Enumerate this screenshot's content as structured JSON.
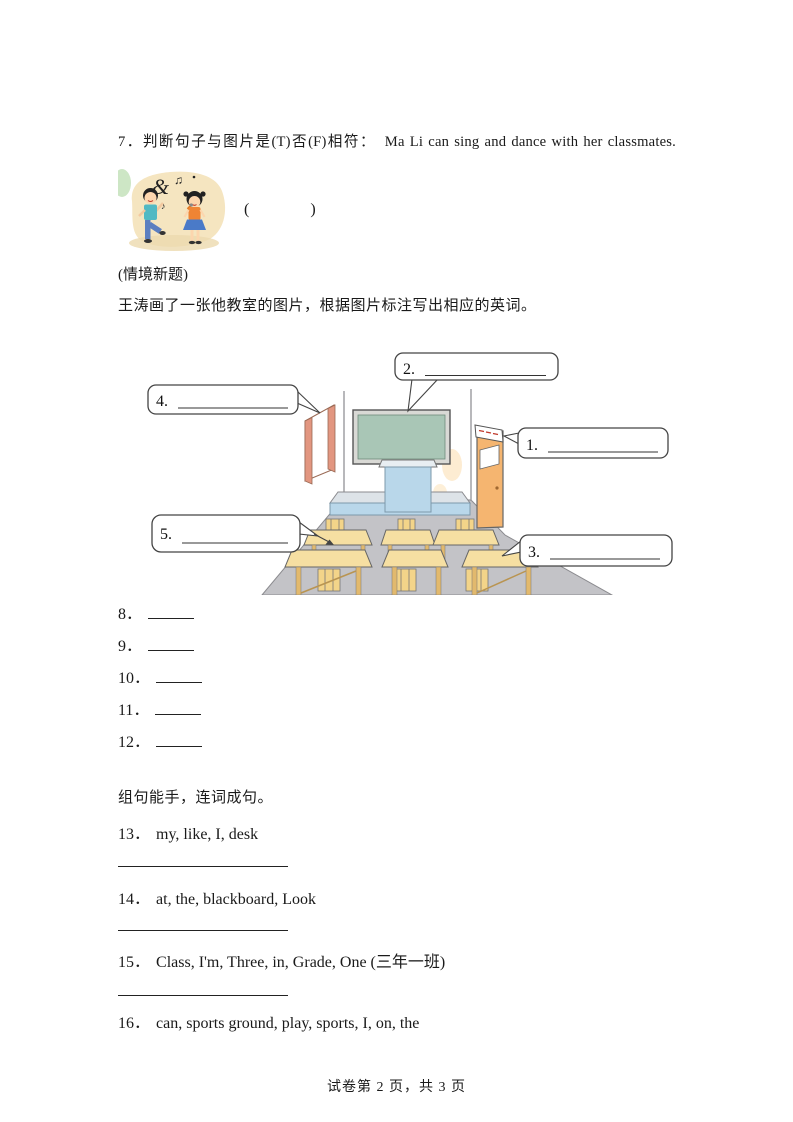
{
  "q7": {
    "number": "7．",
    "text": "判断句子与图片是(T)否(F)相符：　Ma Li can sing and dance with her classmates.",
    "answer_paren": "(            )"
  },
  "context_note": "(情境新题)",
  "instruction": "王涛画了一张他教室的图片，根据图片标注写出相应的英词。",
  "classroom": {
    "callouts": [
      {
        "label": "1."
      },
      {
        "label": "2."
      },
      {
        "label": "3."
      },
      {
        "label": "4."
      },
      {
        "label": "5."
      }
    ]
  },
  "blanks": {
    "items": [
      {
        "number": "8．"
      },
      {
        "number": "9．"
      },
      {
        "number": "10．"
      },
      {
        "number": "11．"
      },
      {
        "number": "12．"
      }
    ]
  },
  "rearrange": {
    "title": "组句能手，连词成句。",
    "items": [
      {
        "number": "13．",
        "words": "my, like, I, desk"
      },
      {
        "number": "14．",
        "words": "at, the, blackboard, Look"
      },
      {
        "number": "15．",
        "words": "Class, I'm, Three, in, Grade, One (三年一班)"
      },
      {
        "number": "16．",
        "words": "can, sports ground, play, sports, I, on, the"
      }
    ]
  },
  "footer": {
    "text": "试卷第 2 页，共 3 页"
  }
}
